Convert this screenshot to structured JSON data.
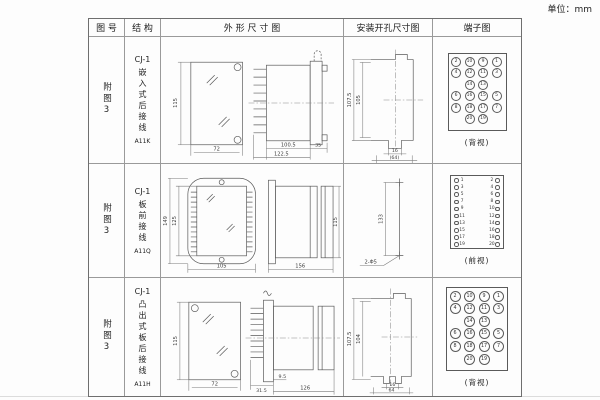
{
  "unit_label": "单位：mm",
  "table": {
    "headers": [
      "图 号",
      "结 构",
      "外 形 尺 寸 图",
      "安装开孔尺寸图",
      "端子图"
    ],
    "rows": [
      {
        "figure_no": "附图3",
        "structure": {
          "model": "CJ-1",
          "desc": "嵌入式后接线",
          "code": "A11K"
        },
        "outline": {
          "h": "115",
          "w": "72",
          "d1": "100.5",
          "d2": "122.5",
          "d3": "35"
        },
        "install": {
          "o": "107.5",
          "i": "105",
          "a": "16",
          "b": "(64)"
        },
        "terminal": {
          "view_label": "(背视)",
          "grid": [
            [
              "2",
              "10",
              "9",
              "1"
            ],
            [
              "4",
              "12",
              "11",
              "3"
            ],
            [
              "",
              "14",
              "13",
              ""
            ],
            [
              "6",
              "16",
              "15",
              "5"
            ],
            [
              "8",
              "18",
              "17",
              "7"
            ],
            [
              "",
              "20",
              "19",
              ""
            ]
          ]
        }
      },
      {
        "figure_no": "附图3",
        "structure": {
          "model": "CJ-1",
          "desc": "板前接线",
          "code": "A11Q"
        },
        "outline": {
          "oh": "149",
          "ih": "125",
          "w": "105",
          "len": "156",
          "h": "115"
        },
        "install": {
          "h": "133",
          "hole": "2-Φ5"
        },
        "terminal": {
          "view_label": "(前视)",
          "left": [
            "1",
            "3",
            "5",
            "7",
            "9",
            "11",
            "13",
            "15",
            "17",
            "19"
          ],
          "right": [
            "2",
            "4",
            "6",
            "8",
            "10",
            "12",
            "14",
            "16",
            "18",
            "20"
          ]
        }
      },
      {
        "figure_no": "附图3",
        "structure": {
          "model": "CJ-1",
          "desc": "凸出式板后接线",
          "code": "A11H"
        },
        "outline": {
          "h": "115",
          "w": "72",
          "d1": "31.5",
          "d2": "9.5",
          "d3": "126"
        },
        "install": {
          "o": "107.5",
          "i": "104",
          "a": "16",
          "b": "64"
        },
        "terminal": {
          "view_label": "(背视)",
          "grid": [
            [
              "2",
              "10",
              "9",
              "1"
            ],
            [
              "4",
              "12",
              "11",
              "3"
            ],
            [
              "",
              "14",
              "13",
              ""
            ],
            [
              "6",
              "16",
              "15",
              "5"
            ],
            [
              "8",
              "18",
              "17",
              "7"
            ],
            [
              "",
              "20",
              "19",
              ""
            ]
          ]
        }
      }
    ]
  }
}
